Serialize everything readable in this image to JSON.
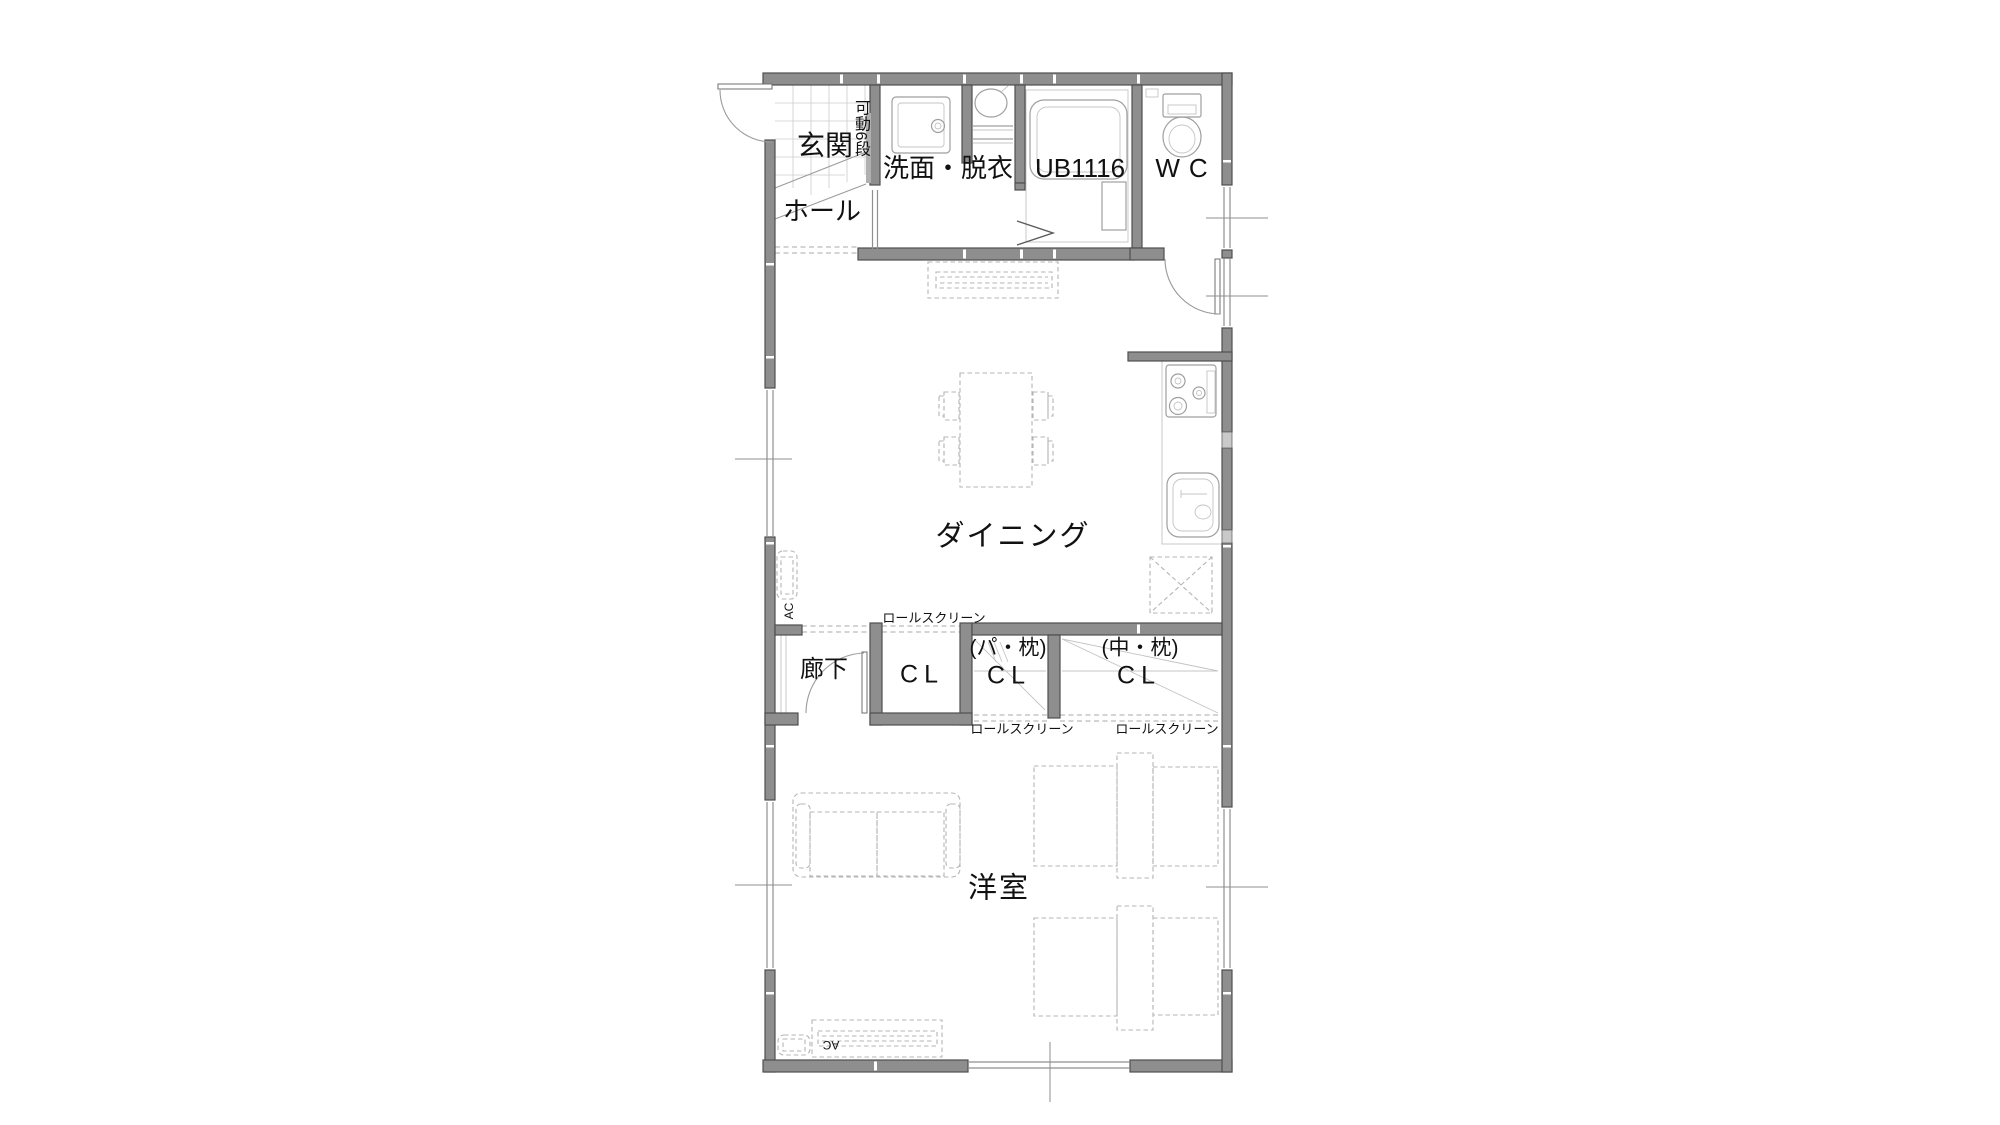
{
  "plan": {
    "rooms": {
      "genkan": "玄関",
      "hall": "ホール",
      "washroom": "洗面・脱衣",
      "bath": "UB1116",
      "wc": "WC",
      "dining": "ダイニング",
      "corridor": "廊下",
      "bedroom": "洋室",
      "closet1": "CL",
      "closet2": "CL",
      "closet3": "CL",
      "closet2_note": "(パ・枕)",
      "closet3_note": "(中・枕)"
    },
    "annotations": {
      "shelf": "可動6段",
      "roll_screen_top": "ロールスクリーン",
      "roll_screen_bottom_left": "ロールスクリーン",
      "roll_screen_bottom_right": "ロールスクリーン",
      "ac_side": "AC",
      "ac_bottom": "AC"
    },
    "colors": {
      "wall": "#8e8e8e",
      "wall_outline": "#4f4f4f",
      "fixture_line": "#9f9f9f",
      "furniture_line": "#b5b5b5",
      "tile_line": "#cccccc",
      "label": "#111111"
    }
  }
}
